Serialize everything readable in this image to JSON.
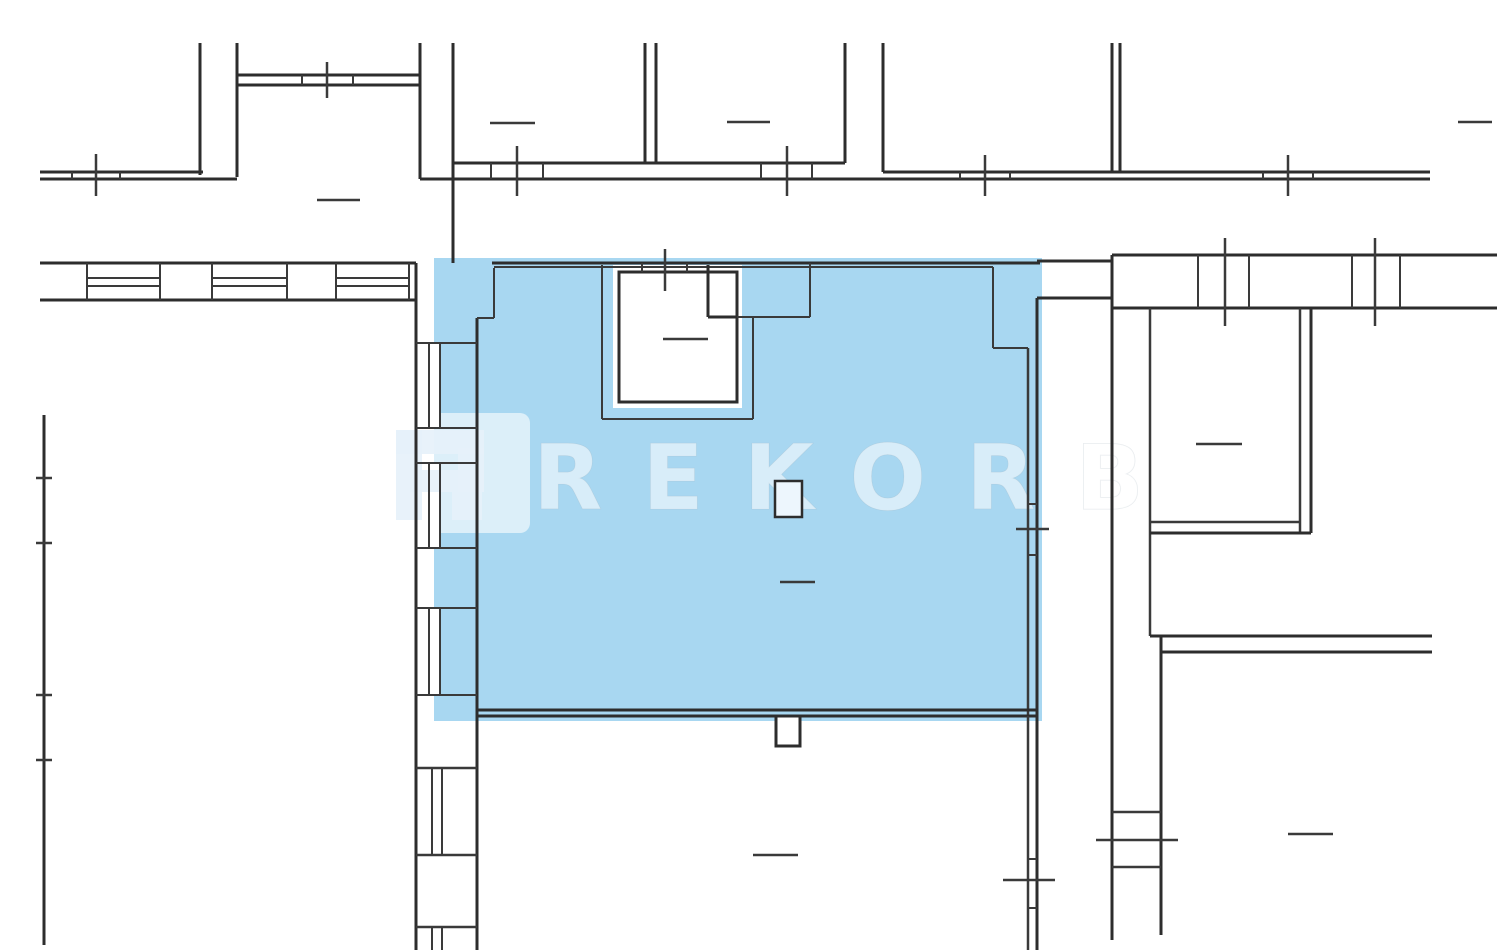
{
  "watermark": {
    "text": "REKORB",
    "text_x": 533,
    "text_baseline_y": 509,
    "font_size": 90,
    "letter_spacing": 40,
    "text_color": "rgba(255,255,255,0.55)",
    "text_edge_color": "rgba(165,180,192,0.28)",
    "logo_square": {
      "x": 368,
      "y": 413,
      "w": 162,
      "h": 120,
      "rx": 10,
      "color": "rgba(255,255,255,0.6)"
    },
    "logo_glyph_name": "rekorb-logo-r",
    "logo_glyph_color": "rgba(230,241,249,0.9)",
    "logo_blocks": [
      [
        396,
        430,
        26,
        90
      ],
      [
        396,
        430,
        88,
        24
      ],
      [
        458,
        448,
        26,
        44
      ],
      [
        410,
        470,
        74,
        22
      ],
      [
        452,
        492,
        30,
        28
      ]
    ]
  },
  "colors": {
    "background": "#FFFFFF",
    "highlight": "#A8D7F1",
    "wall": "#2D2D2D",
    "thin_line": "#3A3A3A",
    "fixture_fill": "#EDF6FD",
    "white": "#FFFFFF"
  },
  "floorplan": {
    "canvas": {
      "w": 1500,
      "h": 950
    },
    "highlights": [
      {
        "x": 434,
        "y": 258,
        "w": 608,
        "h": 463
      }
    ],
    "white_areas": [
      [
        613,
        265,
        129,
        143
      ],
      [
        708,
        265,
        29,
        52
      ],
      [
        416,
        343,
        25,
        85
      ],
      [
        416,
        463,
        25,
        85
      ],
      [
        416,
        608,
        25,
        87
      ],
      [
        416,
        768,
        61,
        87
      ],
      [
        416,
        927,
        61,
        23
      ],
      [
        87,
        263,
        73,
        37
      ],
      [
        212,
        263,
        75,
        37
      ],
      [
        336,
        263,
        73,
        37
      ]
    ],
    "boxes": [
      {
        "x": 619,
        "y": 272,
        "w": 118,
        "h": 130,
        "fill": "#FFFFFF",
        "sw": 3
      },
      {
        "x": 775,
        "y": 481,
        "w": 27,
        "h": 36,
        "fill": "#EDF6FD",
        "sw": 2.5
      },
      {
        "x": 776,
        "y": 716,
        "w": 24,
        "h": 30,
        "fill": "#FFFFFF",
        "sw": 3
      }
    ],
    "lines": [
      [
        200,
        43,
        200,
        175,
        3
      ],
      [
        237,
        43,
        237,
        177,
        3
      ],
      [
        237,
        75,
        420,
        75,
        3
      ],
      [
        237,
        85,
        420,
        85,
        3
      ],
      [
        302,
        75,
        302,
        85,
        2
      ],
      [
        353,
        75,
        353,
        85,
        2
      ],
      [
        327,
        62,
        327,
        98,
        2.5
      ],
      [
        420,
        43,
        420,
        179,
        3
      ],
      [
        453,
        43,
        453,
        263,
        3
      ],
      [
        40,
        172,
        203,
        172,
        3
      ],
      [
        40,
        179,
        237,
        179,
        3
      ],
      [
        72,
        172,
        72,
        179,
        2
      ],
      [
        120,
        172,
        120,
        179,
        2
      ],
      [
        96,
        154,
        96,
        196,
        2.5
      ],
      [
        317,
        200,
        360,
        200,
        2.5
      ],
      [
        645,
        43,
        645,
        163,
        3
      ],
      [
        656,
        43,
        656,
        163,
        3
      ],
      [
        845,
        43,
        845,
        163,
        3
      ],
      [
        883,
        43,
        883,
        172,
        3
      ],
      [
        1112,
        43,
        1112,
        172,
        3
      ],
      [
        1120,
        43,
        1120,
        172,
        3
      ],
      [
        453,
        163,
        845,
        163,
        3
      ],
      [
        883,
        172,
        1430,
        172,
        3
      ],
      [
        420,
        179,
        1430,
        179,
        3
      ],
      [
        491,
        163,
        491,
        179,
        2
      ],
      [
        543,
        163,
        543,
        179,
        2
      ],
      [
        517,
        146,
        517,
        196,
        2.5
      ],
      [
        761,
        163,
        761,
        179,
        2
      ],
      [
        812,
        163,
        812,
        179,
        2
      ],
      [
        787,
        146,
        787,
        196,
        2.5
      ],
      [
        960,
        172,
        960,
        179,
        2
      ],
      [
        1010,
        172,
        1010,
        179,
        2
      ],
      [
        985,
        155,
        985,
        196,
        2.5
      ],
      [
        1263,
        172,
        1263,
        179,
        2
      ],
      [
        1313,
        172,
        1313,
        179,
        2
      ],
      [
        1288,
        155,
        1288,
        196,
        2.5
      ],
      [
        490,
        123,
        535,
        123,
        2.5
      ],
      [
        727,
        122,
        770,
        122,
        2.5
      ],
      [
        1458,
        122,
        1492,
        122,
        2.5
      ],
      [
        1112,
        255,
        1497,
        255,
        3
      ],
      [
        1112,
        308,
        1497,
        308,
        3
      ],
      [
        1198,
        255,
        1198,
        308,
        2
      ],
      [
        1249,
        255,
        1249,
        308,
        2
      ],
      [
        1225,
        238,
        1225,
        326,
        2.5
      ],
      [
        1352,
        255,
        1352,
        308,
        2
      ],
      [
        1400,
        255,
        1400,
        308,
        2
      ],
      [
        1375,
        238,
        1375,
        326,
        2.5
      ],
      [
        1037,
        261,
        1112,
        261,
        3
      ],
      [
        1037,
        298,
        1112,
        298,
        3
      ],
      [
        1112,
        255,
        1112,
        940,
        3
      ],
      [
        1150,
        308,
        1150,
        636,
        2.5
      ],
      [
        1161,
        636,
        1161,
        935,
        3
      ],
      [
        1150,
        636,
        1432,
        636,
        3
      ],
      [
        1161,
        652,
        1432,
        652,
        3
      ],
      [
        1112,
        812,
        1161,
        812,
        2.5
      ],
      [
        1112,
        867,
        1161,
        867,
        2.5
      ],
      [
        1096,
        840,
        1178,
        840,
        2.5
      ],
      [
        1300,
        308,
        1300,
        533,
        2.5
      ],
      [
        1311,
        308,
        1311,
        533,
        3
      ],
      [
        1150,
        522,
        1300,
        522,
        2.5
      ],
      [
        1150,
        533,
        1311,
        533,
        3
      ],
      [
        1196,
        444,
        1242,
        444,
        2.5
      ],
      [
        1288,
        834,
        1333,
        834,
        2.5
      ],
      [
        40,
        263,
        416,
        263,
        3
      ],
      [
        40,
        300,
        416,
        300,
        3
      ],
      [
        87,
        263,
        87,
        300,
        2
      ],
      [
        160,
        263,
        160,
        300,
        2
      ],
      [
        87,
        278,
        160,
        278,
        2
      ],
      [
        87,
        286,
        160,
        286,
        2
      ],
      [
        212,
        263,
        212,
        300,
        2
      ],
      [
        287,
        263,
        287,
        300,
        2
      ],
      [
        212,
        278,
        287,
        278,
        2
      ],
      [
        212,
        286,
        287,
        286,
        2
      ],
      [
        336,
        263,
        336,
        300,
        2
      ],
      [
        409,
        263,
        409,
        300,
        2
      ],
      [
        336,
        278,
        409,
        278,
        2
      ],
      [
        336,
        286,
        409,
        286,
        2
      ],
      [
        44,
        415,
        44,
        945,
        3
      ],
      [
        36,
        478,
        52,
        478,
        2.5
      ],
      [
        36,
        543,
        52,
        543,
        2.5
      ],
      [
        36,
        695,
        52,
        695,
        2.5
      ],
      [
        36,
        760,
        52,
        760,
        2.5
      ],
      [
        416,
        263,
        416,
        950,
        3
      ],
      [
        477,
        318,
        477,
        950,
        3
      ],
      [
        416,
        343,
        477,
        343,
        2
      ],
      [
        416,
        428,
        477,
        428,
        2
      ],
      [
        429,
        343,
        429,
        428,
        2
      ],
      [
        440,
        343,
        440,
        428,
        2
      ],
      [
        416,
        463,
        477,
        463,
        2
      ],
      [
        416,
        548,
        477,
        548,
        2
      ],
      [
        429,
        463,
        429,
        548,
        2
      ],
      [
        440,
        463,
        440,
        548,
        2
      ],
      [
        416,
        608,
        477,
        608,
        2
      ],
      [
        416,
        695,
        477,
        695,
        2
      ],
      [
        429,
        608,
        429,
        695,
        2
      ],
      [
        440,
        608,
        440,
        695,
        2
      ],
      [
        416,
        768,
        477,
        768,
        2.5
      ],
      [
        416,
        855,
        477,
        855,
        2.5
      ],
      [
        432,
        768,
        432,
        855,
        2
      ],
      [
        442,
        768,
        442,
        855,
        2
      ],
      [
        416,
        927,
        477,
        927,
        2.5
      ],
      [
        432,
        927,
        432,
        950,
        2
      ],
      [
        442,
        927,
        442,
        950,
        2
      ],
      [
        492,
        263,
        1040,
        263,
        3
      ],
      [
        494,
        268,
        494,
        318,
        2
      ],
      [
        477,
        318,
        494,
        318,
        2
      ],
      [
        494,
        267,
        993,
        267,
        2
      ],
      [
        993,
        267,
        993,
        348,
        2
      ],
      [
        993,
        348,
        1028,
        348,
        2
      ],
      [
        708,
        317,
        810,
        317,
        2
      ],
      [
        810,
        263,
        810,
        317,
        2
      ],
      [
        1028,
        348,
        1028,
        716,
        2.5
      ],
      [
        1037,
        298,
        1037,
        716,
        3
      ],
      [
        1028,
        504,
        1037,
        504,
        2
      ],
      [
        1028,
        555,
        1037,
        555,
        2
      ],
      [
        1016,
        529,
        1049,
        529,
        2.5
      ],
      [
        477,
        710,
        1037,
        710,
        3
      ],
      [
        477,
        716,
        1037,
        716,
        3
      ],
      [
        1028,
        716,
        1028,
        950,
        2.5
      ],
      [
        1037,
        716,
        1037,
        950,
        3
      ],
      [
        1028,
        859,
        1037,
        859,
        2
      ],
      [
        1028,
        908,
        1037,
        908,
        2
      ],
      [
        1003,
        880,
        1055,
        880,
        2.5
      ],
      [
        602,
        265,
        602,
        419,
        2
      ],
      [
        602,
        419,
        753,
        419,
        2
      ],
      [
        753,
        317,
        753,
        419,
        2
      ],
      [
        708,
        265,
        708,
        317,
        3
      ],
      [
        708,
        317,
        737,
        317,
        3
      ],
      [
        642,
        263,
        642,
        272,
        2
      ],
      [
        687,
        263,
        687,
        272,
        2
      ],
      [
        665,
        249,
        665,
        291,
        2.5
      ],
      [
        663,
        339,
        708,
        339,
        2.5
      ],
      [
        780,
        582,
        815,
        582,
        2.5
      ],
      [
        753,
        855,
        798,
        855,
        2.5
      ]
    ]
  }
}
